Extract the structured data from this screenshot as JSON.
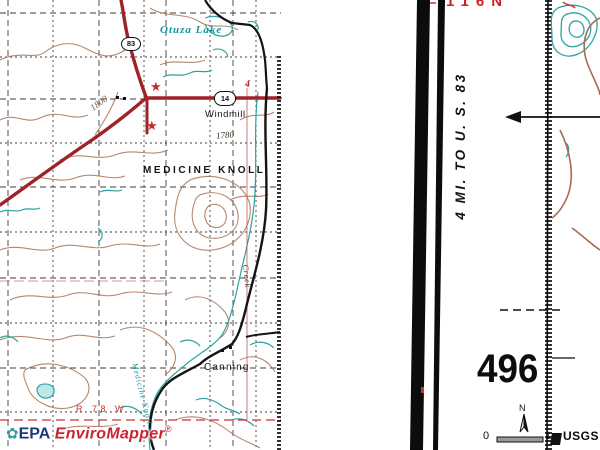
{
  "map": {
    "labels": {
      "lake": "Otuza Lake",
      "windmill": "Windmill",
      "knoll": "MEDICINE KNOLL",
      "town": "Canning",
      "range": "R 78 W",
      "elev_a": "1780",
      "elev_b": "1800",
      "creek_upper": "Creek",
      "creek_lower": "Medicine Knoll",
      "route_shield_main": "83",
      "route_shield_east": "14",
      "red_numeral": "4",
      "star_marker": "★"
    }
  },
  "branding": {
    "flower_icon": "✿",
    "agency": "EPA",
    "product": "EnviroMapper",
    "registered": "®"
  },
  "margin": {
    "township": "116N",
    "distance_note": "4 MI. TO U. S. 83",
    "sheet_number": "496",
    "north": "N",
    "scale_start": "0",
    "scale_end": "1",
    "usgs": "USGS"
  },
  "colors": {
    "contour_brown": "#ad7b5d",
    "water_teal": "#2aa3a3",
    "road_red": "#9e2226",
    "label_red": "#cc2222",
    "epa_blue": "#1a3a7c",
    "brand_red": "#cc2233"
  }
}
